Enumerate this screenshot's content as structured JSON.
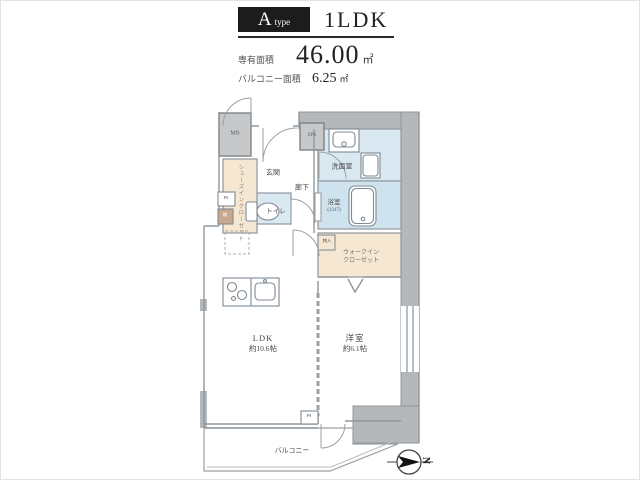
{
  "header": {
    "type_letter": "A",
    "type_word": "type",
    "layout": "1LDK",
    "area_label": "専有面積",
    "area_value": "46.00",
    "area_unit": "㎡",
    "balcony_label": "バルコニー面積",
    "balcony_value": "6.25",
    "balcony_unit": "㎡"
  },
  "plan": {
    "mb": "MB",
    "eps": "EPS",
    "entrance": "玄関",
    "sic_line1": "シューズイン",
    "sic_line2": "クローゼット",
    "hallway": "廊下",
    "toilet": "トイレ",
    "ps": "PS",
    "shelf": "棚",
    "washroom": "洗面室",
    "bathroom": "浴室",
    "bathroom_size": "(1317)",
    "storage": "物入",
    "wic_line1": "ウォークイン",
    "wic_line2": "クローゼット",
    "ldk_name": "LDK",
    "ldk_size": "約10.6帖",
    "bedroom_name": "洋室",
    "bedroom_size": "約6.1帖",
    "balcony": "バルコニー",
    "ps2": "PS"
  },
  "compass": {
    "north": "N"
  },
  "colors": {
    "ink": "#1c1c1c",
    "wall-gray": "#b5b8ba",
    "box-gray": "#c6c8c9",
    "wet-blue": "#d9e8f1",
    "closet-beige": "#f5e7d2",
    "shelf-tan": "#c8a98d",
    "line": "#8f979c"
  }
}
